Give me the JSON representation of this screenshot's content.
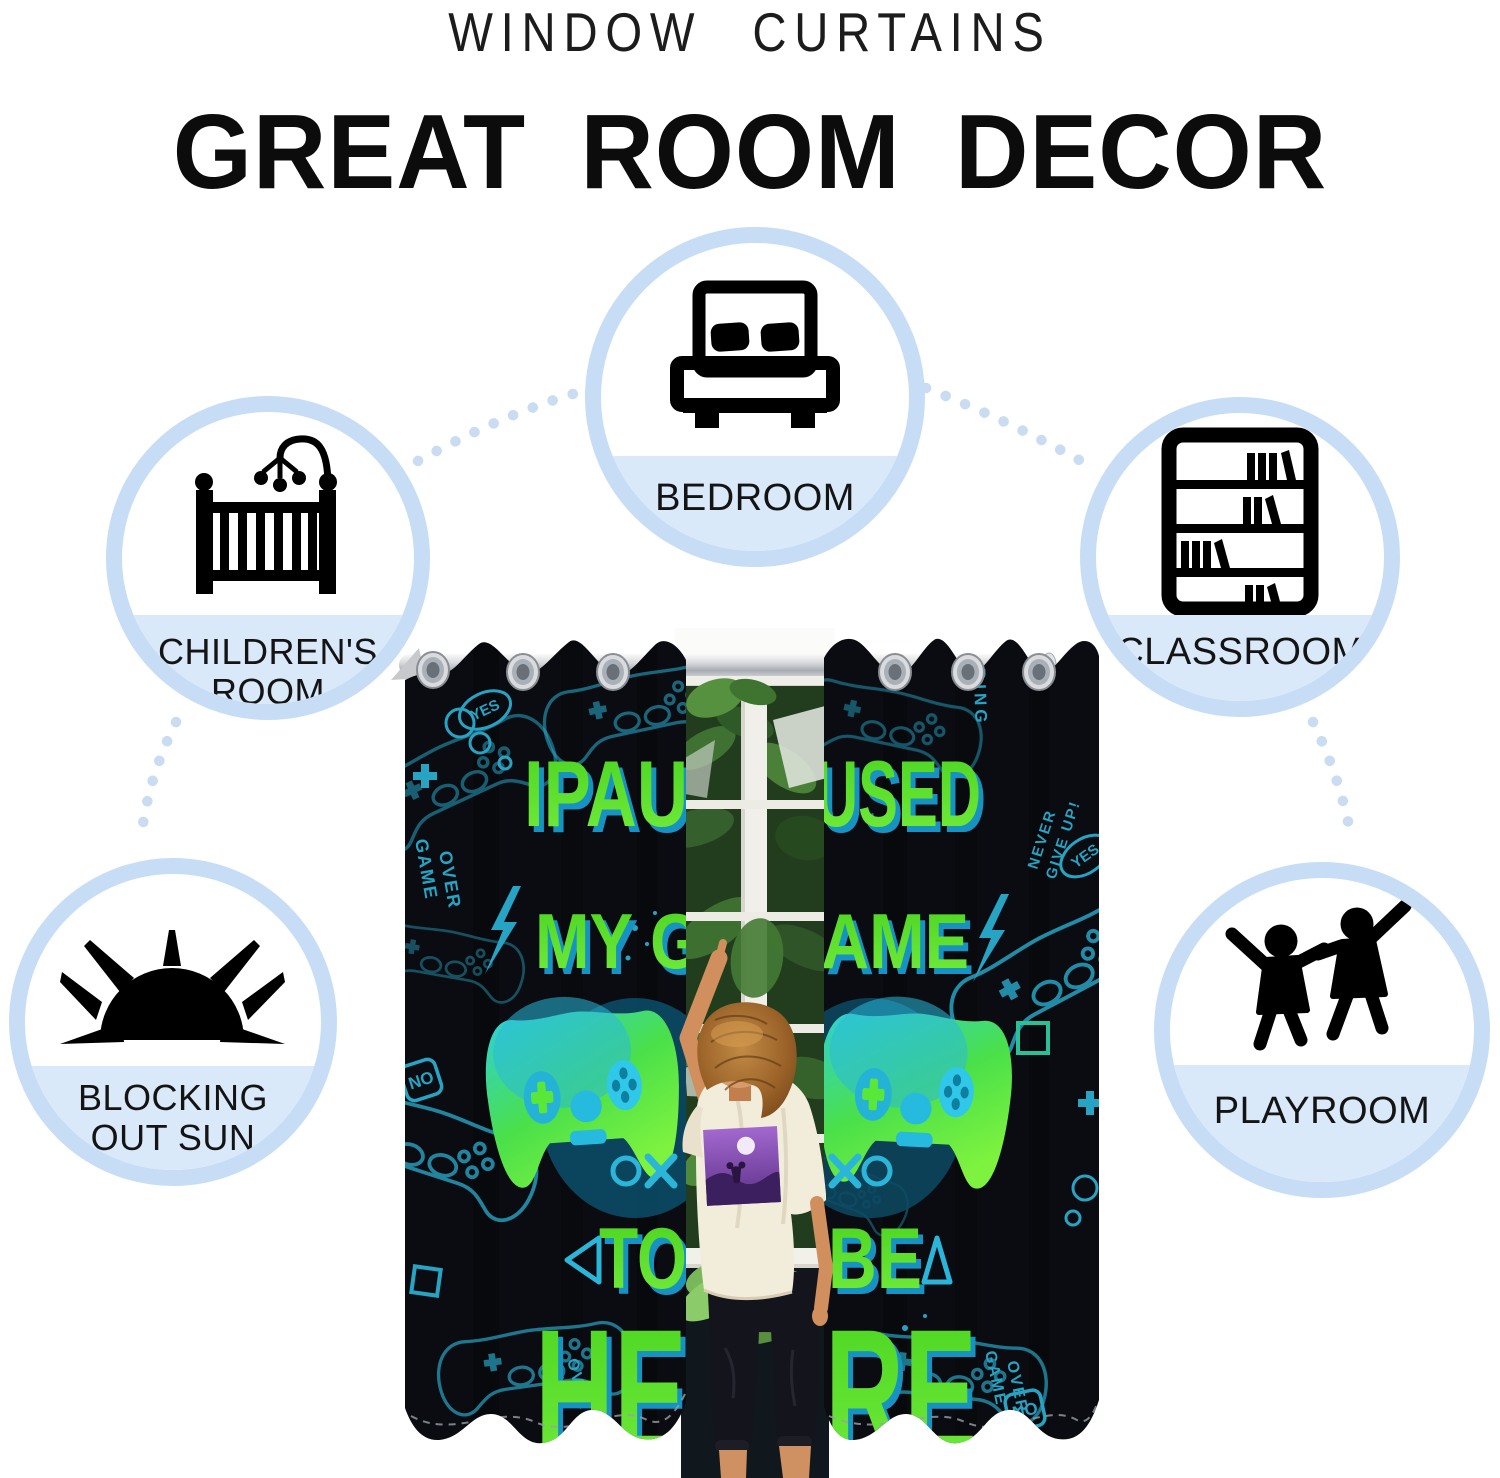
{
  "header": {
    "subtitle": "WINDOW CURTAINS",
    "title": "GREAT ROOM DECOR"
  },
  "features": [
    {
      "id": "bedroom",
      "icon": "bed-icon",
      "lines": [
        "BEDROOM"
      ]
    },
    {
      "id": "childrens-room",
      "icon": "crib-icon",
      "lines": [
        "CHILDREN'S",
        "ROOM"
      ]
    },
    {
      "id": "classroom",
      "icon": "bookshelf-icon",
      "lines": [
        "CLASSROOM"
      ]
    },
    {
      "id": "blocking-out-sun",
      "icon": "sun-icon",
      "lines": [
        "BLOCKING",
        "OUT SUN"
      ]
    },
    {
      "id": "playroom",
      "icon": "playing-kids-icon",
      "lines": [
        "PLAYROOM"
      ]
    }
  ],
  "product_photo": {
    "curtain_slogan": "I PAUSED MY GAME TO BE HERE",
    "slogan_fragments": {
      "l1l": "IPAU",
      "l1r": "USED",
      "l2l": "MY G",
      "l2r": "AME",
      "l3l": "TO",
      "l3r": "BE",
      "l4l": "HE",
      "l4r": "RE"
    },
    "doodle_words": {
      "game": "GAME",
      "over": "OVER",
      "yes": "YES",
      "no": "NO",
      "loading": "ADING",
      "never": "NEVER",
      "give_up": "GIVE UP!"
    },
    "symbols": [
      "X",
      "O",
      "square",
      "triangle",
      "lightning"
    ],
    "colors": {
      "curtain": "#0a0c11",
      "doodle": "#2bb5d8",
      "slogan_green": "#55e42c"
    }
  },
  "colors": {
    "circle_ring": "#c7ddf5",
    "circle_chord": "#d9e9fa",
    "dots": "#c9dcf2",
    "heading": "#0c0c0c"
  }
}
